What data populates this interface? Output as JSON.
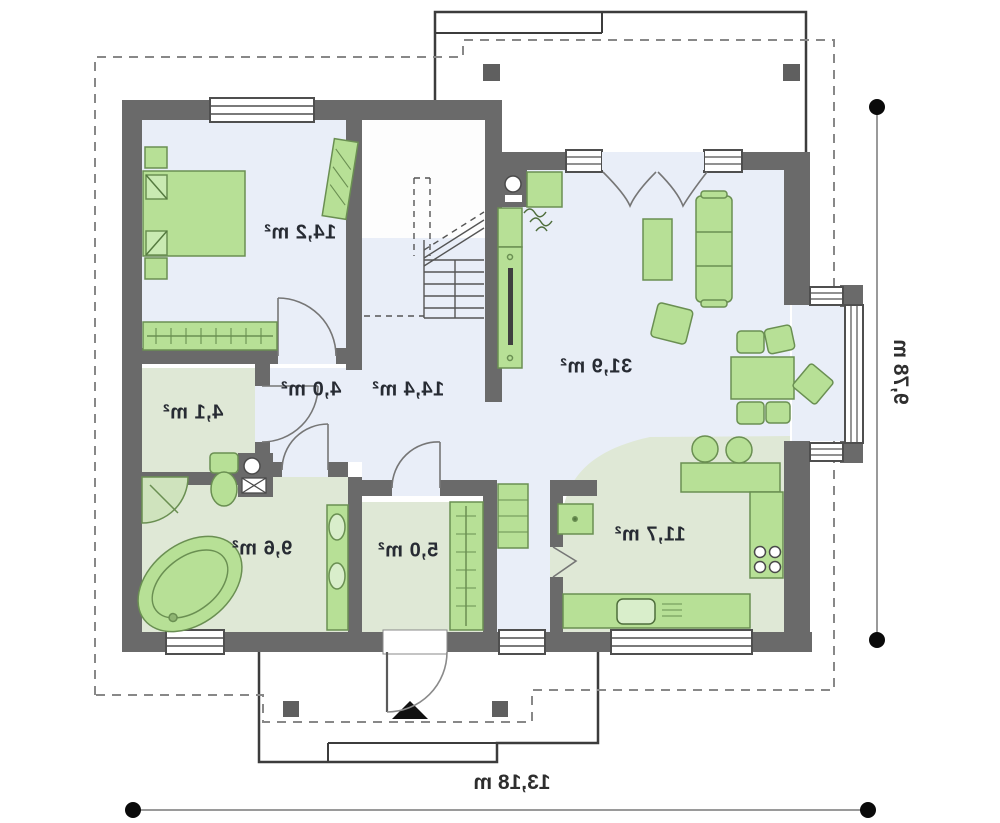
{
  "plan": {
    "title": "single-storey house floor plan (mirrored print)",
    "rooms": [
      {
        "id": "bedroom",
        "area_label": "14,2 m²"
      },
      {
        "id": "corridor",
        "area_label": "4,0 m²"
      },
      {
        "id": "hall",
        "area_label": "14,4 m²"
      },
      {
        "id": "closet",
        "area_label": "4,1 m²"
      },
      {
        "id": "bathroom",
        "area_label": "9,6 m²"
      },
      {
        "id": "vestibule",
        "area_label": "5,0 m²"
      },
      {
        "id": "kitchen",
        "area_label": "11,7 m²"
      },
      {
        "id": "living-room",
        "area_label": "31,9 m²"
      }
    ],
    "dimensions": {
      "width_label": "13,18 m",
      "height_label": "9,78 m"
    },
    "colors": {
      "wall": "#6a6a6a",
      "floor_blue": "#e9eef8",
      "floor_green": "#dfe8d6",
      "furniture_green": "#b7e096",
      "furniture_stroke": "#6a8f52",
      "outline_dark": "#3c3c3c",
      "dashed_roof": "#888888",
      "dimension_line": "#9a9a9a"
    },
    "furniture": {
      "bedroom": [
        "double-bed",
        "nightstand",
        "nightstand",
        "wardrobe",
        "corner-desk"
      ],
      "bathroom": [
        "corner-shower",
        "bathtub",
        "toilet",
        "washbasin-counter",
        "vent-stack"
      ],
      "vestibule": [
        "coat-wardrobe"
      ],
      "hall": [
        "staircase",
        "drawer-cabinet"
      ],
      "kitchen": [
        "fridge",
        "bar-counter",
        "bar-stool",
        "bar-stool",
        "cooktop-counter",
        "sink-counter"
      ],
      "living_room": [
        "fireplace",
        "chimney",
        "tv-bench",
        "coffee-table",
        "sofa",
        "armchair",
        "dining-table",
        "chair",
        "chair",
        "chair",
        "chair",
        "chair"
      ]
    },
    "markers": [
      "entrance-arrow",
      "terrace-post",
      "porch-post"
    ]
  }
}
